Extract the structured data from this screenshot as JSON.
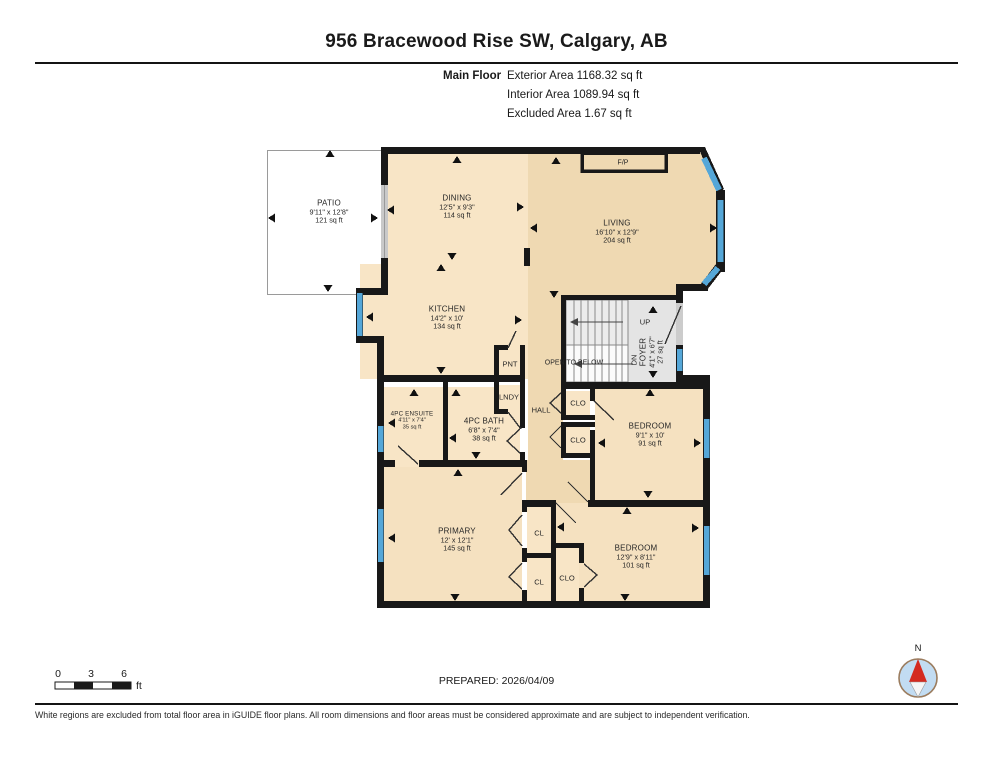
{
  "header": {
    "title": "956 Bracewood Rise SW, Calgary, AB",
    "floor_label": "Main Floor",
    "areas": [
      "Exterior Area 1168.32 sq ft",
      "Interior Area 1089.94 sq ft",
      "Excluded Area 1.67 sq ft"
    ]
  },
  "rooms": [
    {
      "id": "patio",
      "name": "PATIO",
      "dims": "9'11\" x 12'8\"",
      "area": "121 sq ft"
    },
    {
      "id": "dining",
      "name": "DINING",
      "dims": "12'5\" x 9'3\"",
      "area": "114 sq ft"
    },
    {
      "id": "living",
      "name": "LIVING",
      "dims": "16'10\" x 12'9\"",
      "area": "204 sq ft"
    },
    {
      "id": "kitchen",
      "name": "KITCHEN",
      "dims": "14'2\" x 10'",
      "area": "134 sq ft"
    },
    {
      "id": "foyer",
      "name": "FOYER",
      "dims": "4'1\" x 6'7\"",
      "area": "27 sq ft"
    },
    {
      "id": "ensuite",
      "name": "4PC ENSUITE",
      "dims": "4'11\" x 7'4\"",
      "area": "35 sq ft"
    },
    {
      "id": "bath",
      "name": "4PC BATH",
      "dims": "6'8\" x 7'4\"",
      "area": "38 sq ft"
    },
    {
      "id": "bedroom-east",
      "name": "BEDROOM",
      "dims": "9'1\" x 10'",
      "area": "91 sq ft"
    },
    {
      "id": "primary",
      "name": "PRIMARY",
      "dims": "12' x 12'1\"",
      "area": "145 sq ft"
    },
    {
      "id": "bedroom-south",
      "name": "BEDROOM",
      "dims": "12'9\" x 8'11\"",
      "area": "101 sq ft"
    }
  ],
  "labels": {
    "fireplace": "F/P",
    "pantry": "PNT",
    "laundry": "LNDY",
    "hall": "HALL",
    "stairs_up": "UP",
    "stairs_down": "DN",
    "open_to_below": "OPEN TO BELOW",
    "closet": "CLO",
    "closet_small": "CL",
    "compass_north": "N"
  },
  "scale_bar": {
    "ticks": [
      "0",
      "3",
      "6"
    ],
    "unit": "ft"
  },
  "footer": {
    "prepared": "PREPARED: 2026/04/09",
    "disclaimer": "White regions are excluded from total floor area in iGUIDE floor plans. All room dimensions and floor areas must be considered approximate and are subject to independent verification."
  },
  "colors": {
    "wall": "#181818",
    "window_blue": "#55a7d8",
    "floor_main_tan": "#efd9b2",
    "floor_light_cream": "#f8e5c6",
    "stairs_gray": "#e4e4e4",
    "compass_red": "#d42a20"
  }
}
